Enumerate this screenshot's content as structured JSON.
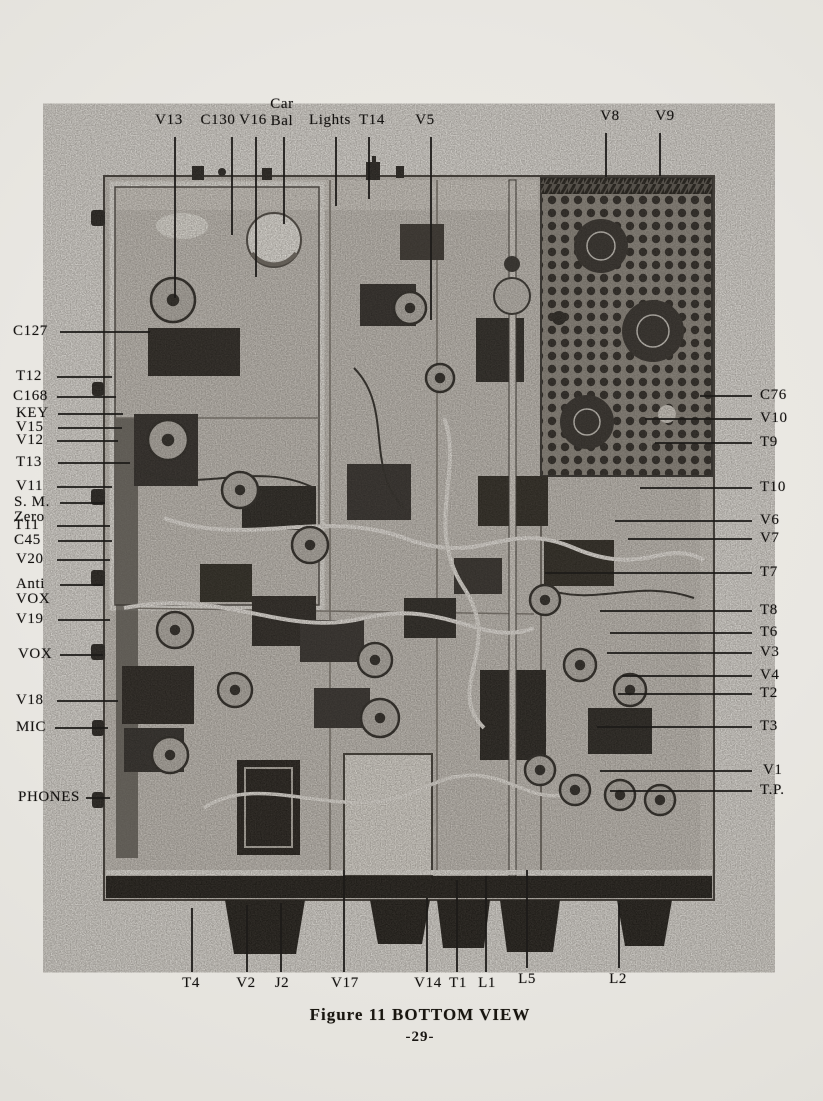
{
  "figure": {
    "caption": "Figure 11 BOTTOM VIEW",
    "page_number": "-29-",
    "photo_subject": "chassis-bottom-view-photograph"
  },
  "labels": {
    "top": [
      {
        "text": "V13"
      },
      {
        "text": "C130"
      },
      {
        "text": "V16"
      },
      {
        "text": "Car\nBal"
      },
      {
        "text": "Lights"
      },
      {
        "text": "T14"
      },
      {
        "text": "V5"
      },
      {
        "text": "V8"
      },
      {
        "text": "V9"
      }
    ],
    "left": [
      {
        "text": "C127"
      },
      {
        "text": "T12"
      },
      {
        "text": "C168"
      },
      {
        "text": "KEY"
      },
      {
        "text": "V15"
      },
      {
        "text": "V12"
      },
      {
        "text": "T13"
      },
      {
        "text": "V11"
      },
      {
        "text": "S. M.\nZero"
      },
      {
        "text": "T11"
      },
      {
        "text": "C45"
      },
      {
        "text": "V20"
      },
      {
        "text": "Anti\nVOX"
      },
      {
        "text": "V19"
      },
      {
        "text": "VOX"
      },
      {
        "text": "V18"
      },
      {
        "text": "MIC"
      },
      {
        "text": "PHONES"
      }
    ],
    "right": [
      {
        "text": "C76"
      },
      {
        "text": "V10"
      },
      {
        "text": "T9"
      },
      {
        "text": "T10"
      },
      {
        "text": "V6"
      },
      {
        "text": "V7"
      },
      {
        "text": "T7"
      },
      {
        "text": "T8"
      },
      {
        "text": "T6"
      },
      {
        "text": "V3"
      },
      {
        "text": "V4"
      },
      {
        "text": "T2"
      },
      {
        "text": "T3"
      },
      {
        "text": "V1"
      },
      {
        "text": "T.P."
      }
    ],
    "bottom": [
      {
        "text": "T4"
      },
      {
        "text": "V2"
      },
      {
        "text": "J2"
      },
      {
        "text": "V17"
      },
      {
        "text": "V14"
      },
      {
        "text": "T1"
      },
      {
        "text": "L1"
      },
      {
        "text": "L5"
      },
      {
        "text": "L2"
      }
    ]
  }
}
